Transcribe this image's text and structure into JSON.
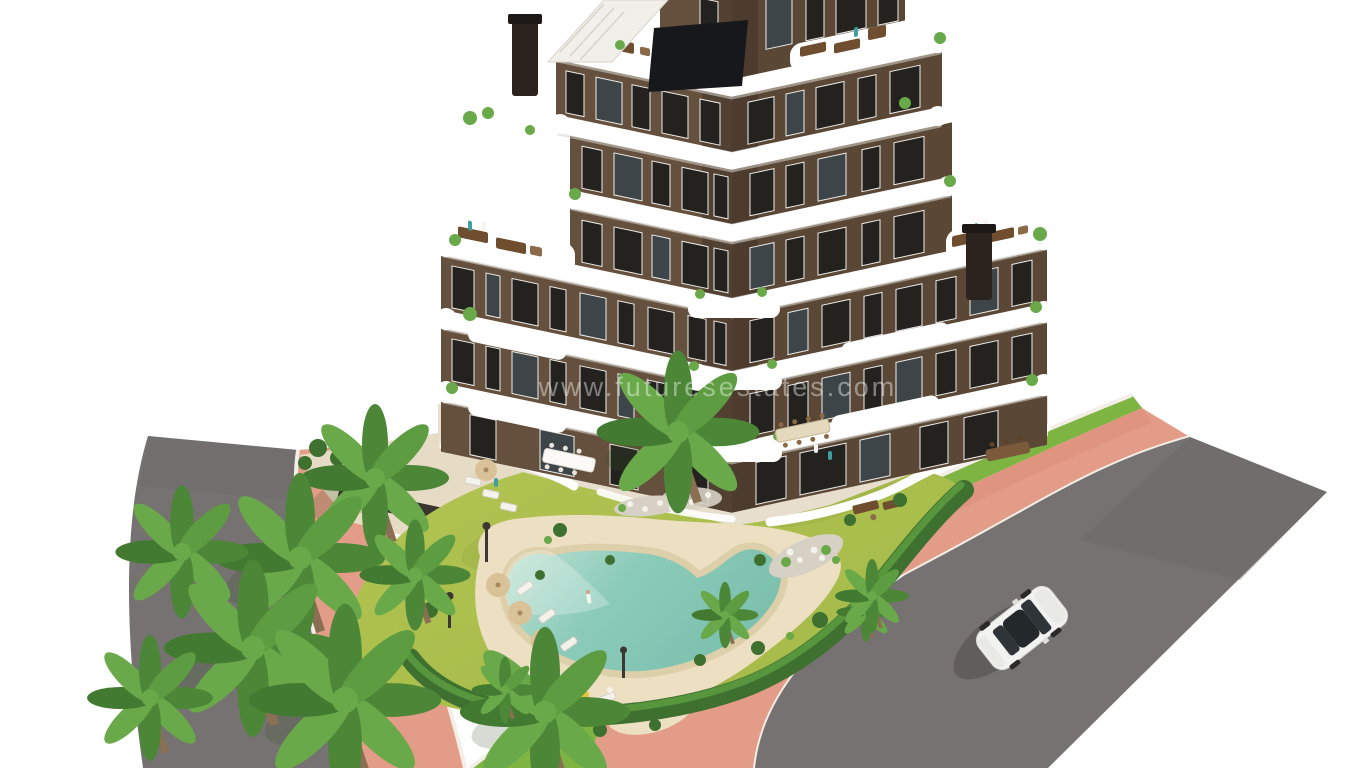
{
  "scene": {
    "type": "architectural-3d-render",
    "description": "Aerial render of a modern V-shaped apartment building with tiered white wavy balconies, roof terraces, landscaped garden, free-form pool, palm trees, pink pavements, asphalt roads and a white car",
    "watermark": "www.futuresestates.com",
    "objects": [
      "apartment-building",
      "balcony-slabs",
      "roof-terraces",
      "chimneys",
      "roof-staircase",
      "penthouse-glazing",
      "garden-lawn",
      "swimming-pool",
      "pool-deck",
      "sun-loungers",
      "parasols",
      "palm-trees",
      "hedge",
      "pink-sidewalks",
      "asphalt-roads",
      "white-car",
      "lamp-posts",
      "watermark"
    ]
  },
  "colors": {
    "bg": "#ffffff",
    "road": "#767271",
    "roadDark": "#6b6767",
    "sidewalk": "#e39c88",
    "sidewalkDeep": "#d98a74",
    "curb": "#f3efe8",
    "verge": "#7eb441",
    "lawn": "#abbf4e",
    "lawnLight": "#bcca59",
    "lawnDark": "#8ba03f",
    "hedge": "#3e7030",
    "hedgeLight": "#5a9a3f",
    "palm1": "#4c8738",
    "palm2": "#69a94a",
    "trunk": "#8a6f52",
    "sand": "#ecdfc2",
    "sandDeep": "#dccfa9",
    "poolShallow": "#c2e4d4",
    "pool": "#8ccbba",
    "poolDeep": "#7cc0ae",
    "wallL": "#64503c",
    "wallR": "#5b4735",
    "wallDark": "#3f3227",
    "slab": "#ffffff",
    "slabShadow": "#d7d3cc",
    "win": "#23221f",
    "winLight": "#3d4549",
    "frame": "#efeeea",
    "chimney": "#2b241e",
    "terrace": "#e7decd",
    "gravel": "#d6d1c4",
    "stone": "#f4f2ec",
    "sofa": "#6f4e30",
    "parasol": "#d9c198",
    "car": "#f2f2f0",
    "carGlass": "#2e3437",
    "personTeal": "#3f9ea0",
    "personWhite": "#f7f5ef",
    "wallStrip": "#3a3531"
  }
}
